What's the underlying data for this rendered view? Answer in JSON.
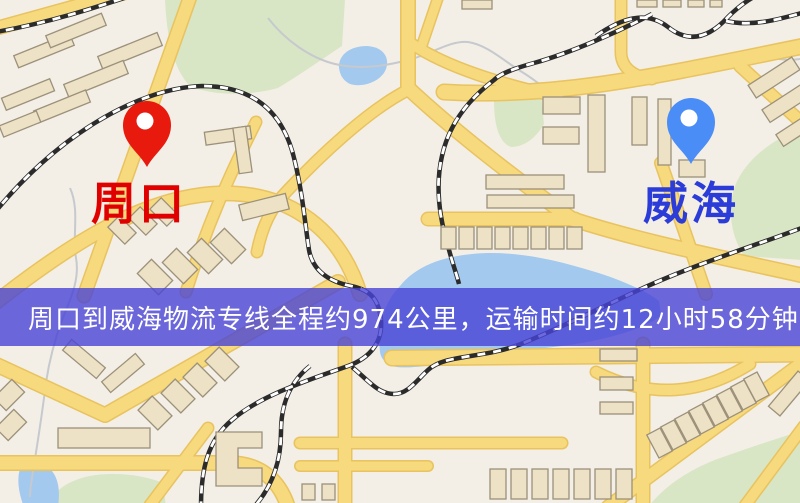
{
  "banner": {
    "text": "周口到威海物流专线全程约974公里，运输时间约12小时58分钟.",
    "background_color": "#4944d6",
    "text_color": "#ffffff"
  },
  "route": {
    "origin": "周口",
    "destination": "威海",
    "distance_text": "约974公里",
    "duration_text": "约12小时58分钟"
  },
  "markers": [
    {
      "id": "origin",
      "label": "周口",
      "pin_color": "#e8190d",
      "label_color": "#e00000",
      "x": 147,
      "y": 167
    },
    {
      "id": "destination",
      "label": "威海",
      "pin_color": "#4b8df6",
      "label_color": "#2b3cd8",
      "x": 691,
      "y": 164
    }
  ],
  "map": {
    "background_color": "#f3efe6",
    "road_color": "#f7d97e",
    "road_casing_color": "#e8c35f",
    "building_color": "#ede1c6",
    "building_stroke_color": "#9c917a",
    "park_color": "#d9e6c5",
    "water_color": "#a3c9ef",
    "railway_color": "#2b2b2b",
    "stream_color": "#c6c9cd"
  }
}
